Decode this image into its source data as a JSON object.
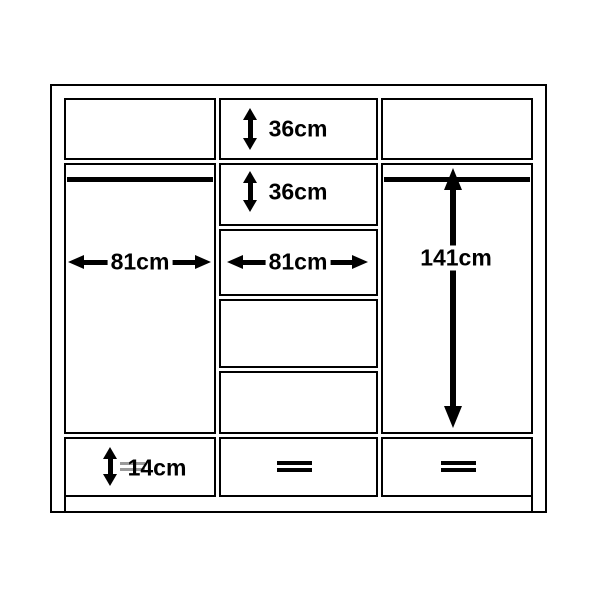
{
  "colors": {
    "bg": "#ffffff",
    "line": "#000000",
    "label": "#000000",
    "handle-grey": "#9a9a9a"
  },
  "icons": {
    "drawer_handle": "double-horizontal-bar (=)",
    "dimension_arrow": "double-headed-arrow"
  },
  "dimensions": [
    {
      "id": "top-shelf-height",
      "label": "36cm"
    },
    {
      "id": "second-shelf-height",
      "label": "36cm"
    },
    {
      "id": "left-section-width",
      "label": "81cm"
    },
    {
      "id": "middle-section-width",
      "label": "81cm"
    },
    {
      "id": "right-hanging-height",
      "label": "141cm"
    },
    {
      "id": "left-drawer-height",
      "label": "14cm"
    }
  ]
}
